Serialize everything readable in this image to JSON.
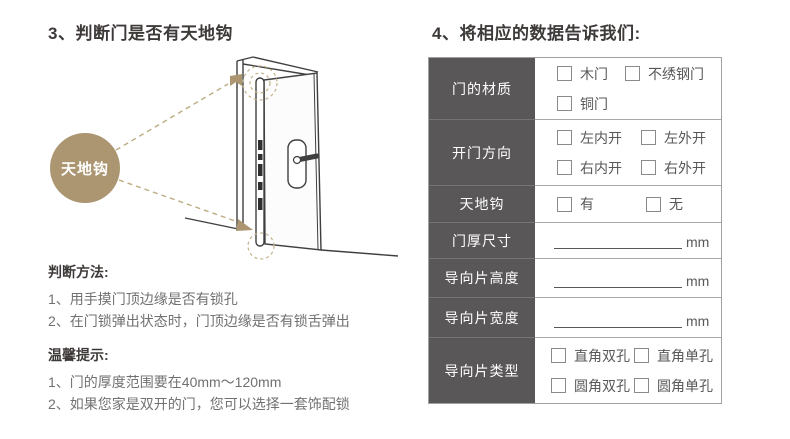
{
  "accent": {
    "tan": "#ab9671",
    "label_bg": "#595757"
  },
  "section3": {
    "title": "3、判断门是否有天地钩",
    "hook_badge": "天地钩",
    "method": {
      "heading": "判断方法:",
      "items": [
        "1、用手摸门顶边缘是否有锁孔",
        "2、在门锁弹出状态时，门顶边缘是否有锁舌弹出"
      ]
    },
    "tips": {
      "heading": "温馨提示:",
      "items": [
        "1、门的厚度范围要在40mm～120mm",
        "2、如果您家是双开的门，您可以选择一套饰配锁"
      ]
    }
  },
  "section4": {
    "title": "4、将相应的数据告诉我们:",
    "table": {
      "rows": [
        {
          "label": "门的材质",
          "options": [
            "木门",
            "不绣钢门",
            "铜门"
          ]
        },
        {
          "label": "开门方向",
          "options": [
            "左内开",
            "左外开",
            "右内开",
            "右外开"
          ]
        },
        {
          "label": "天地钩",
          "options": [
            "有",
            "无"
          ]
        },
        {
          "label": "门厚尺寸",
          "unit": "mm"
        },
        {
          "label": "导向片高度",
          "unit": "mm"
        },
        {
          "label": "导向片宽度",
          "unit": "mm"
        },
        {
          "label": "导向片类型",
          "options": [
            "直角双孔",
            "直角单孔",
            "圆角双孔",
            "圆角单孔"
          ]
        }
      ]
    }
  }
}
